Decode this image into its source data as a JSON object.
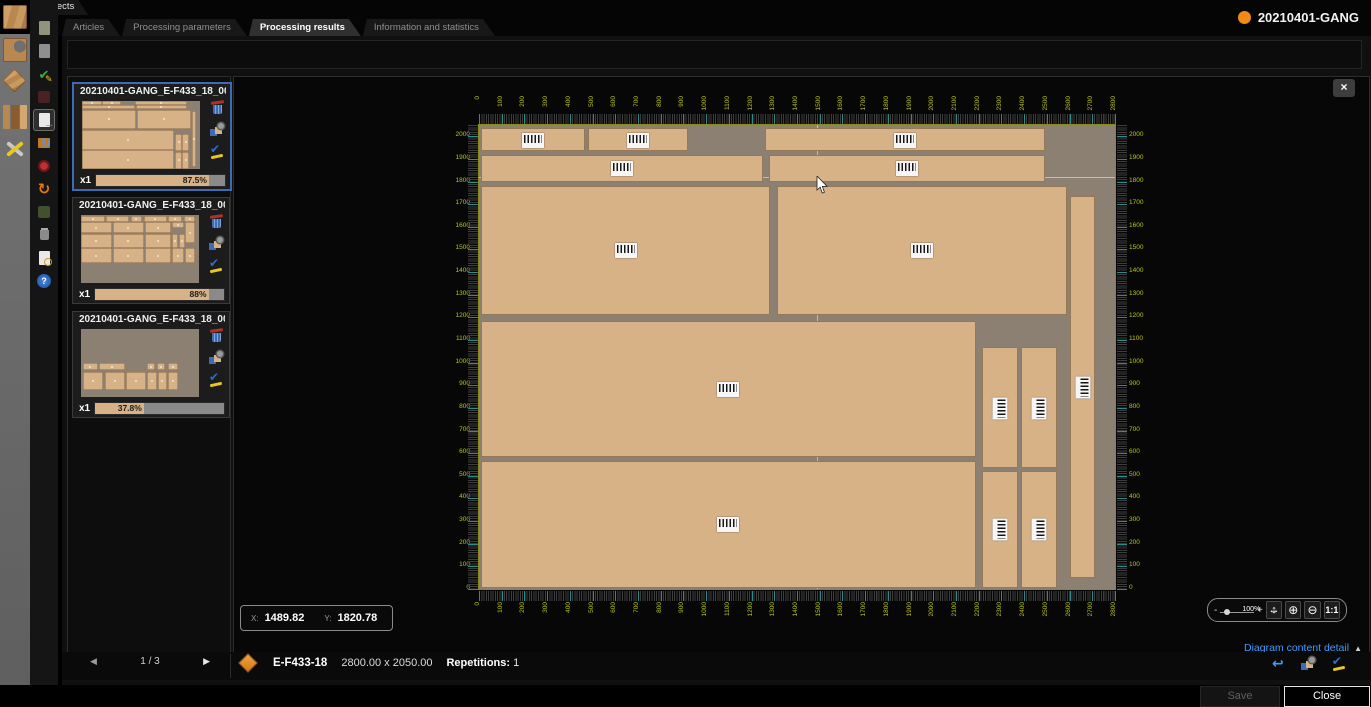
{
  "app": {
    "projects_tab": "Projects",
    "project_name": "20210401-GANG"
  },
  "tabs": [
    {
      "label": "Articles",
      "active": false
    },
    {
      "label": "Processing parameters",
      "active": false
    },
    {
      "label": "Processing results",
      "active": true
    },
    {
      "label": "Information and statistics",
      "active": false
    }
  ],
  "colors": {
    "panel": "#d8b287",
    "waste": "#8b8071",
    "ruler_text": "#b9c41f",
    "tick_major": "#2e8b8b",
    "selection": "#3d6cb4",
    "link": "#3f9bff",
    "accent_orange": "#f28a18",
    "crosshair": "#e6e42e"
  },
  "icon_glyphs": {
    "check": "✔",
    "pencil": "✎",
    "redo": "↻",
    "undo": "↩",
    "move_h": "↔",
    "move_v": "↕",
    "zoom_in": "⊕",
    "zoom_out": "⊖",
    "expander": "▶",
    "help": "?"
  },
  "dialog": {
    "close_icon": "×"
  },
  "thumbnails": [
    {
      "title": "20210401-GANG_E-F433_18_000...",
      "multiplier": "x1",
      "efficiency": "87.5%",
      "fill": 87.5,
      "selected": true,
      "preview_source": "diagram"
    },
    {
      "title": "20210401-GANG_E-F433_18_000...",
      "multiplier": "x1",
      "efficiency": "88%",
      "fill": 88,
      "selected": false,
      "preview": [
        [
          0,
          1,
          20,
          9
        ],
        [
          21,
          1,
          20,
          9
        ],
        [
          42,
          1,
          10,
          9
        ],
        [
          53,
          1,
          20,
          9
        ],
        [
          74,
          1,
          12,
          9
        ],
        [
          87,
          1,
          10,
          9
        ],
        [
          0,
          11,
          26,
          16
        ],
        [
          27,
          11,
          26,
          16
        ],
        [
          54,
          11,
          22,
          16
        ],
        [
          77,
          11,
          10,
          8
        ],
        [
          0,
          28,
          26,
          20
        ],
        [
          27,
          28,
          26,
          20
        ],
        [
          54,
          28,
          22,
          20
        ],
        [
          77,
          28,
          5,
          20
        ],
        [
          83,
          28,
          5,
          20
        ],
        [
          0,
          49,
          26,
          22
        ],
        [
          27,
          49,
          26,
          22
        ],
        [
          54,
          49,
          22,
          22
        ],
        [
          77,
          49,
          10,
          22
        ],
        [
          88,
          11,
          9,
          30
        ],
        [
          88,
          49,
          9,
          22
        ]
      ]
    },
    {
      "title": "20210401-GANG_E-F433_18_000...",
      "multiplier": "x1",
      "efficiency": "37.8%",
      "fill": 37.8,
      "selected": false,
      "preview": [
        [
          2,
          50,
          12,
          11
        ],
        [
          15,
          50,
          22,
          11
        ],
        [
          56,
          50,
          7,
          11
        ],
        [
          64,
          50,
          7,
          11
        ],
        [
          74,
          50,
          8,
          11
        ],
        [
          2,
          63,
          17,
          26
        ],
        [
          20,
          63,
          17,
          26
        ],
        [
          38,
          63,
          17,
          26
        ],
        [
          56,
          63,
          8,
          26
        ],
        [
          65,
          63,
          8,
          26
        ],
        [
          74,
          63,
          8,
          26
        ]
      ]
    }
  ],
  "pagination": {
    "prev": "◀",
    "page": "1 / 3",
    "next": "▶"
  },
  "part_info": {
    "name": "E-F433-18",
    "dimensions": "2800.00 x 2050.00",
    "repetitions_label": "Repetitions:",
    "repetitions_value": "1"
  },
  "coordinates": {
    "x_label": "X:",
    "x_value": "1489.82",
    "y_label": "Y:",
    "y_value": "1820.78"
  },
  "zoom_controls": {
    "minus": "-",
    "plus": "+",
    "percent": "100%",
    "ratio": "1:1"
  },
  "detail_link": {
    "label": "Diagram content detail",
    "collapse_icon": "▲"
  },
  "footer": {
    "save": "Save",
    "close": "Close"
  },
  "diagram": {
    "stock_width": 2800,
    "stock_height": 2050,
    "crosshair": {
      "x": 1489.82,
      "y": 1820.78
    },
    "ruler": {
      "step": 100,
      "x_max": 2800,
      "y_max": 2000
    },
    "panels": [
      {
        "x": 10,
        "y": 1935,
        "w": 455,
        "h": 100,
        "bc": "h"
      },
      {
        "x": 482,
        "y": 1935,
        "w": 438,
        "h": 100,
        "bc": "h"
      },
      {
        "x": 1260,
        "y": 1935,
        "w": 1232,
        "h": 100,
        "bc": "h"
      },
      {
        "x": 10,
        "y": 1800,
        "w": 1240,
        "h": 118,
        "bc": "h"
      },
      {
        "x": 1276,
        "y": 1800,
        "w": 1216,
        "h": 118,
        "bc": "h"
      },
      {
        "x": 10,
        "y": 1212,
        "w": 1272,
        "h": 568,
        "bc": "h"
      },
      {
        "x": 1312,
        "y": 1212,
        "w": 1276,
        "h": 568,
        "bc": "h"
      },
      {
        "x": 2602,
        "y": 50,
        "w": 112,
        "h": 1688,
        "bc": "v"
      },
      {
        "x": 10,
        "y": 585,
        "w": 2176,
        "h": 600,
        "bc": "h"
      },
      {
        "x": 10,
        "y": 4,
        "w": 2176,
        "h": 562,
        "bc": "h"
      },
      {
        "x": 2216,
        "y": 535,
        "w": 156,
        "h": 532,
        "bc": "v"
      },
      {
        "x": 2384,
        "y": 535,
        "w": 160,
        "h": 532,
        "bc": "v"
      },
      {
        "x": 2216,
        "y": 4,
        "w": 156,
        "h": 518,
        "bc": "v"
      },
      {
        "x": 2384,
        "y": 4,
        "w": 160,
        "h": 518,
        "bc": "v"
      }
    ]
  }
}
